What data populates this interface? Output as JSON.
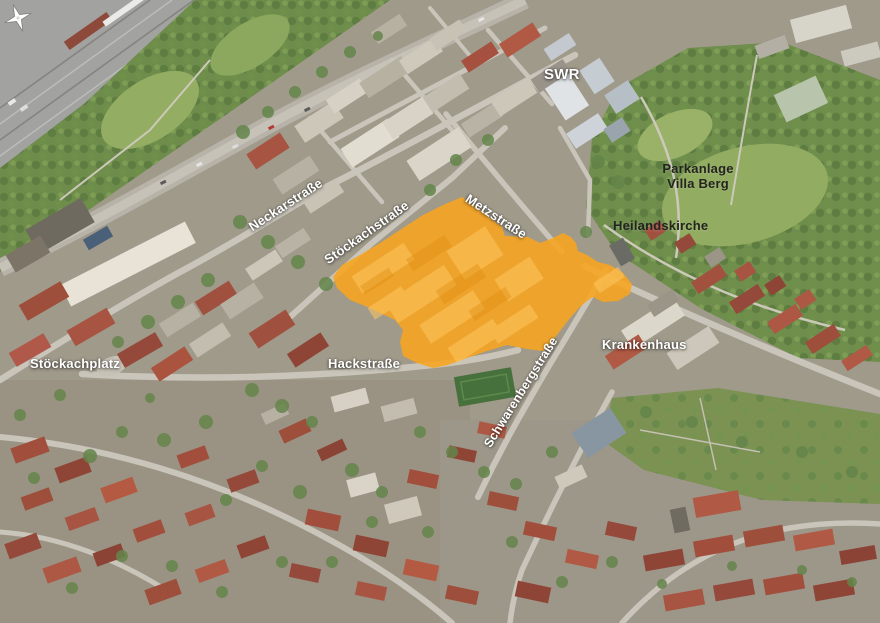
{
  "labels": {
    "swr": "SWR",
    "parkanlage_line1": "Parkanlage",
    "parkanlage_line2": "Villa Berg",
    "heilandskirche": "Heilandskirche",
    "neckarstrasse": "Neckarstraße",
    "stoeckachstrasse": "Stöckachstraße",
    "metzstrasse": "Metzstraße",
    "krankenhaus": "Krankenhaus",
    "stoeckachplatz": "Stöckachplatz",
    "hackstrasse": "Hackstraße",
    "schwarenbergstrasse": "Schwarenbergstraße"
  },
  "highlight": {
    "color": "#F8A41E",
    "opacity": "0.87"
  },
  "label_colors": {
    "light": "#FFFFFF",
    "dark": "#23231F"
  },
  "icons": {
    "compass": "compass-rose-icon"
  }
}
